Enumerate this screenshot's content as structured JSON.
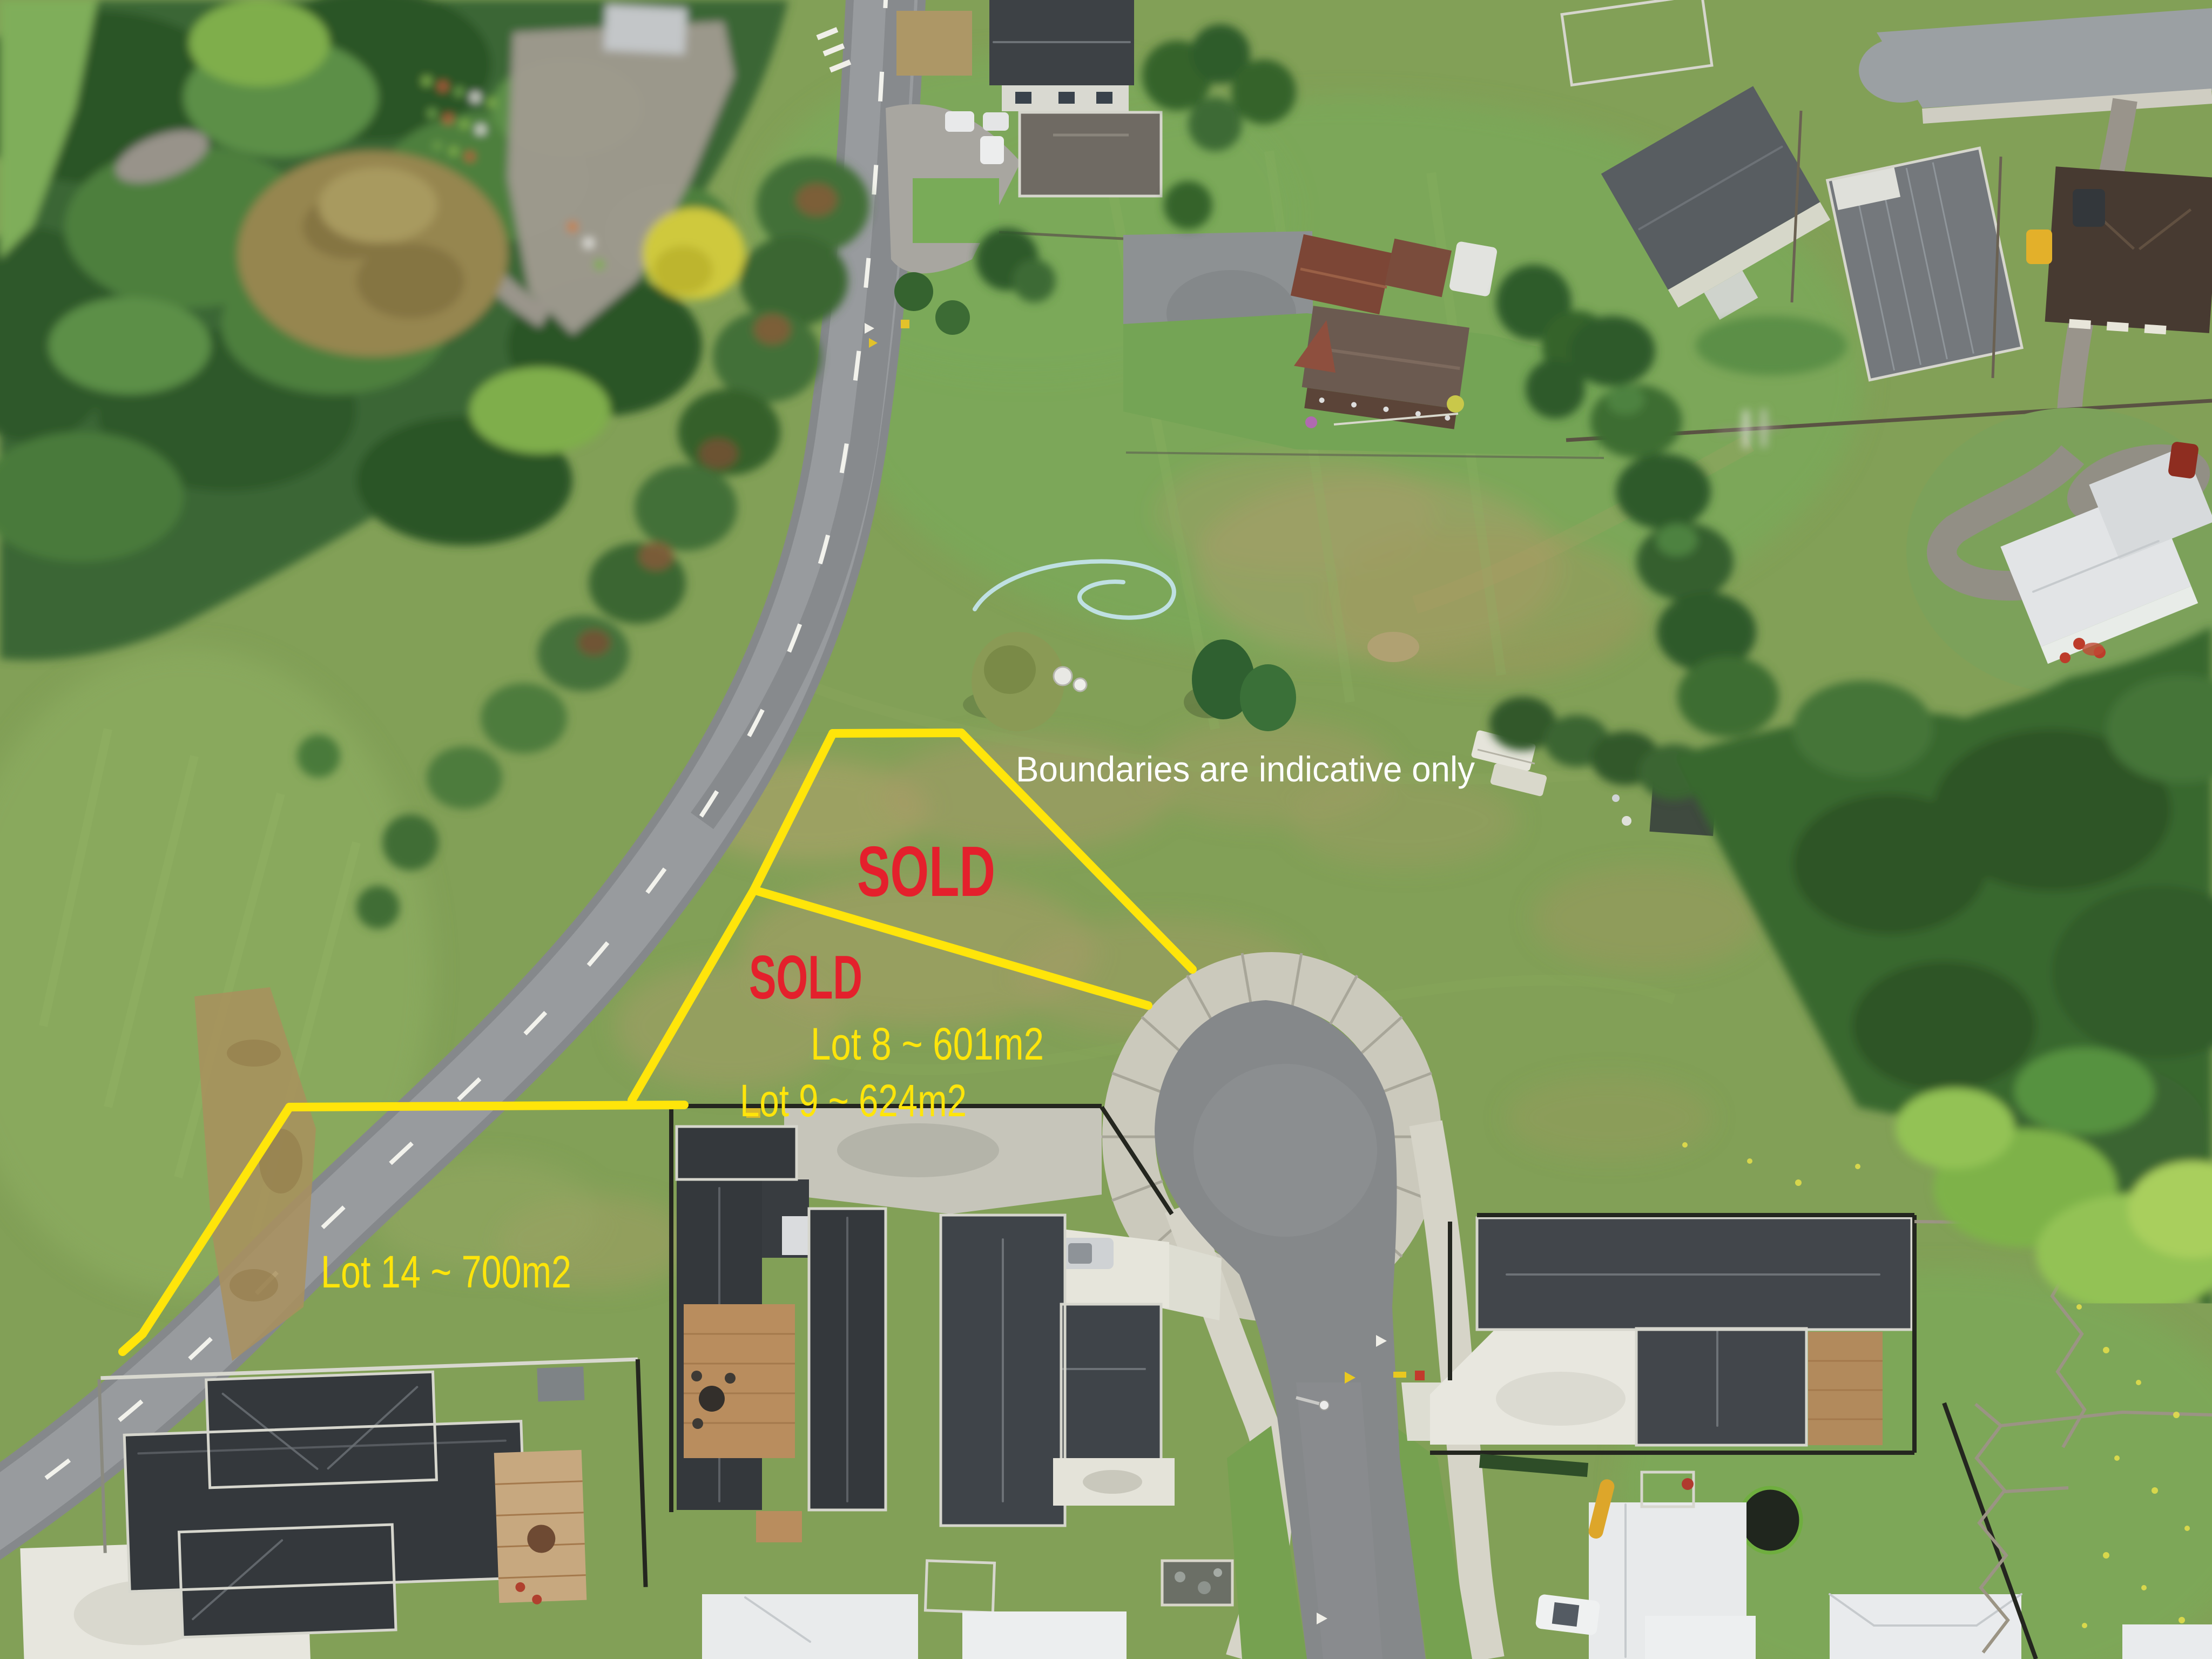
{
  "scene": {
    "type": "aerial-drone-photo",
    "subject": "residential subdivision with vacant lots, cul-de-sac street, rural road and surrounding houses"
  },
  "annotations": {
    "disclaimer": "Boundaries are indicative only",
    "lots": [
      {
        "name": "Lot 8",
        "label": "Lot 8 ~ 601m2",
        "area_m2": 601,
        "status": "SOLD"
      },
      {
        "name": "Lot 9",
        "label": "Lot 9 ~ 624m2",
        "area_m2": 624,
        "status": "SOLD"
      },
      {
        "name": "Lot 14",
        "label": "Lot 14 ~ 700m2",
        "area_m2": 700,
        "status": ""
      }
    ],
    "colors": {
      "boundary_line": "#ffe50a",
      "sold_text": "#e4202c",
      "lot_label_text": "#ffe50a",
      "disclaimer_text": "#ffffff"
    }
  }
}
